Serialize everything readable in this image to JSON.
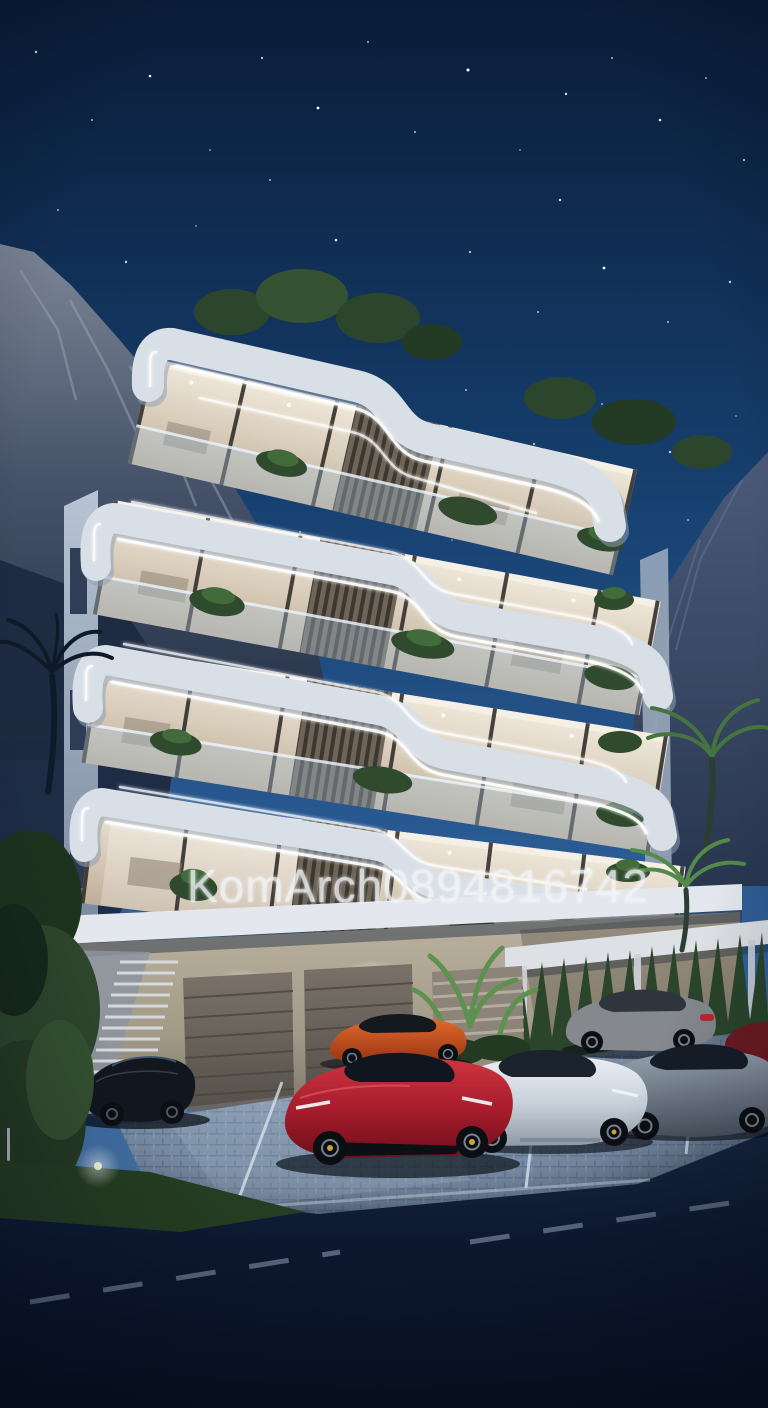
{
  "image": {
    "description": "Night-time photorealistic 3D architectural rendering of a modern curved white apartment building with LED strip lighting, rooftop trees, mountains behind, and luxury sports cars parked in front",
    "time_of_day": "dusk",
    "render_style": "photorealistic 3D exterior visualization"
  },
  "watermark": {
    "text": "KomArch0894816742"
  },
  "building": {
    "floors": 4,
    "garage_doors": 2,
    "features": [
      "curved LED-lit balcony bands",
      "glass balustrades",
      "wood slat screens",
      "rooftop garden trees",
      "street-level garage",
      "outdoor staircase",
      "carport"
    ]
  },
  "vehicles": [
    {
      "id": "black-coupe",
      "color_key": "car_black",
      "position": "far left"
    },
    {
      "id": "red-supercar",
      "color_key": "car_red",
      "position": "front center"
    },
    {
      "id": "orange-supercar",
      "color_key": "car_orange",
      "position": "behind red supercar"
    },
    {
      "id": "white-supercar",
      "color_key": "car_white",
      "position": "center right"
    },
    {
      "id": "gray-supercar",
      "color_key": "car_gray",
      "position": "right"
    },
    {
      "id": "silver-sedan",
      "color_key": "car_sedan",
      "position": "under carport"
    },
    {
      "id": "dark-red-car",
      "color_key": "car_darkred",
      "position": "far right edge"
    }
  ],
  "palette": {
    "sky_top": "#0a1c38",
    "sky_mid": "#16406f",
    "sky_low": "#3f6da1",
    "sky_horizon": "#54799f",
    "mountain_hi": "#7c8696",
    "mountain_lo": "#2a3850",
    "mountain_r_hi": "#4a5a78",
    "mountain_r_lo": "#283650",
    "fascia": "#d9dfe7",
    "fascia_shadow": "#8fa0b2",
    "led": "#ffffff",
    "interior_hi": "#efe8da",
    "interior_lo": "#bfae98",
    "mullion": "#332f2a",
    "slat": "#6e6458",
    "slat_dark": "#3c372f",
    "plant": "#2f4a2d",
    "plant_dark": "#1e311d",
    "plant_light": "#538a49",
    "stone": "#b3a997",
    "stone_dim": "#8f8878",
    "slab": "#e4e8ee",
    "door": "#6e665e",
    "door_dark": "#54504a",
    "paver_hi": "#8094ae",
    "paver_lo": "#495d7c",
    "stall_line": "#dbe6f2",
    "road": "#0d1830",
    "dash": "#9db0c8",
    "grass": "#253d22",
    "hedge": "#2c452c",
    "car_red": "#b02030",
    "car_red_dk": "#74101e",
    "car_orange": "#d4541f",
    "car_white": "#dfe4ea",
    "car_white_dk": "#9aa6b3",
    "car_gray": "#828d9a",
    "car_gray_dk": "#515c6a",
    "car_black": "#12171f",
    "car_sedan": "#85888d",
    "car_darkred": "#6e1a22",
    "tire": "#0b0e12",
    "rim": "#78828f",
    "cabin": "#141b25"
  },
  "stars": [
    [
      36,
      52,
      1.2,
      0.9
    ],
    [
      92,
      120,
      1,
      0.7
    ],
    [
      150,
      76,
      1.3,
      0.95
    ],
    [
      210,
      150,
      0.9,
      0.6
    ],
    [
      262,
      58,
      1.1,
      0.8
    ],
    [
      318,
      108,
      1.4,
      1
    ],
    [
      368,
      42,
      1,
      0.7
    ],
    [
      415,
      132,
      1,
      0.75
    ],
    [
      468,
      70,
      1.5,
      1
    ],
    [
      520,
      150,
      0.9,
      0.6
    ],
    [
      566,
      94,
      1.2,
      0.85
    ],
    [
      612,
      58,
      1,
      0.7
    ],
    [
      660,
      120,
      1.3,
      0.9
    ],
    [
      706,
      78,
      1,
      0.7
    ],
    [
      744,
      160,
      1.1,
      0.8
    ],
    [
      58,
      210,
      1,
      0.65
    ],
    [
      126,
      262,
      1.2,
      0.8
    ],
    [
      196,
      226,
      0.9,
      0.55
    ],
    [
      268,
      288,
      1,
      0.7
    ],
    [
      336,
      240,
      1.3,
      0.9
    ],
    [
      402,
      300,
      0.9,
      0.6
    ],
    [
      470,
      252,
      1.1,
      0.75
    ],
    [
      538,
      312,
      1,
      0.65
    ],
    [
      604,
      268,
      1.4,
      0.95
    ],
    [
      668,
      322,
      1,
      0.7
    ],
    [
      730,
      282,
      1.2,
      0.8
    ],
    [
      44,
      356,
      1,
      0.6
    ],
    [
      116,
      398,
      1.1,
      0.7
    ],
    [
      188,
      362,
      0.9,
      0.55
    ],
    [
      258,
      418,
      1,
      0.65
    ],
    [
      330,
      376,
      1.2,
      0.8
    ],
    [
      398,
      432,
      0.9,
      0.55
    ],
    [
      466,
      390,
      1,
      0.7
    ],
    [
      534,
      444,
      1.1,
      0.75
    ],
    [
      602,
      404,
      1,
      0.6
    ],
    [
      670,
      452,
      1.2,
      0.8
    ],
    [
      736,
      416,
      0.9,
      0.55
    ],
    [
      76,
      478,
      1,
      0.6
    ],
    [
      150,
      512,
      1.1,
      0.7
    ],
    [
      224,
      488,
      0.9,
      0.5
    ],
    [
      300,
      532,
      1,
      0.65
    ],
    [
      376,
      498,
      1.2,
      0.75
    ],
    [
      452,
      540,
      0.9,
      0.5
    ],
    [
      528,
      508,
      1,
      0.65
    ],
    [
      606,
      548,
      1.1,
      0.7
    ],
    [
      688,
      520,
      1,
      0.6
    ],
    [
      740,
      560,
      1.2,
      0.75
    ],
    [
      270,
      180,
      1,
      0.7
    ],
    [
      560,
      200,
      1.2,
      0.85
    ]
  ]
}
